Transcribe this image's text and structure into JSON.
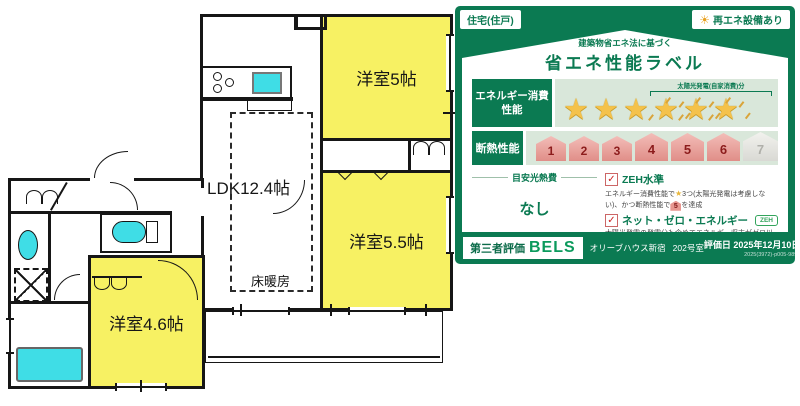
{
  "floorplan": {
    "rooms": {
      "r5": "洋室5帖",
      "ldk": "LDK12.4帖",
      "r55": "洋室5.5帖",
      "r46": "洋室4.6帖",
      "heating": "床暖房"
    }
  },
  "label_panel": {
    "badge_left": "住宅(住戸)",
    "badge_right": "再エネ設備あり",
    "subtitle": "建築物省エネ法に基づく",
    "title": "省エネ性能ラベル",
    "energy_row_label": "エネルギー消費性能",
    "solar_bracket": "太陽光発電(自家消費)分",
    "stars_total": 6,
    "stars_solar": 3,
    "insulation_row_label": "断熱性能",
    "insulation_levels": [
      "1",
      "2",
      "3",
      "4",
      "5",
      "6",
      "7"
    ],
    "insulation_achieved": 6,
    "insulation_achieved_label": "5",
    "utility_cost_label": "目安光熱費",
    "utility_cost_value": "なし",
    "zeh_title": "ZEH水準",
    "zeh_desc_pre": "エネルギー消費性能で",
    "zeh_desc_mid": "3つ(太陽光発電は考慮しない)、かつ断熱性能で",
    "zeh_desc_post": "を達成",
    "nze_title": "ネット・ゼロ・エネルギー",
    "zeh_badge": "ZEH",
    "nze_desc": "太陽光発電の発電分も含めてエネルギー収支がゼロ以下を達成",
    "footer": {
      "third_party": "第三者評価",
      "bels": "BELS",
      "property": "オリーブハウス新宿",
      "room": "202号室",
      "eval_date": "評価日 2025年12月10日",
      "cert_no": "2025(3972)-p005-9894"
    }
  },
  "icons": {
    "star": "★",
    "check": "✓",
    "sun": "☀"
  },
  "colors": {
    "panel_green": "#0b7a52",
    "row_light_green": "#d9e7da",
    "room_yellow": "#f7f163",
    "fixture_cyan": "#3fdde6",
    "star_gold": "#f4c24b",
    "insulation_pink": "#e79790",
    "check_red": "#cc2222"
  }
}
